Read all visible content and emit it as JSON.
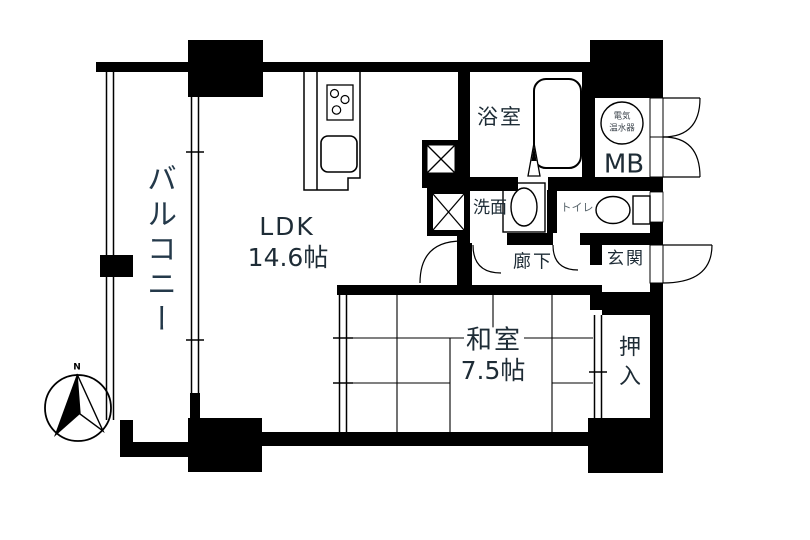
{
  "title": "apartment-floor-plan",
  "colors": {
    "wall": "#000000",
    "line": "#111111",
    "label": "#1e2c36",
    "label_light": "#5a666d",
    "background": "#ffffff"
  },
  "rooms": {
    "balcony": {
      "label": "バルコニー"
    },
    "ldk": {
      "label": "LDK",
      "size": "14.6帖"
    },
    "bath": {
      "label": "浴室"
    },
    "meter_box": {
      "label": "MB"
    },
    "water_heater": {
      "line1": "電気",
      "line2": "温水器"
    },
    "washroom": {
      "label": "洗面"
    },
    "toilet": {
      "label": "トイレ"
    },
    "hallway": {
      "label": "廊下"
    },
    "entrance": {
      "label": "玄関"
    },
    "japanese_room": {
      "label": "和室",
      "size": "7.5帖"
    },
    "closet": {
      "label": "押入"
    }
  },
  "compass": {
    "north_label": "N"
  }
}
